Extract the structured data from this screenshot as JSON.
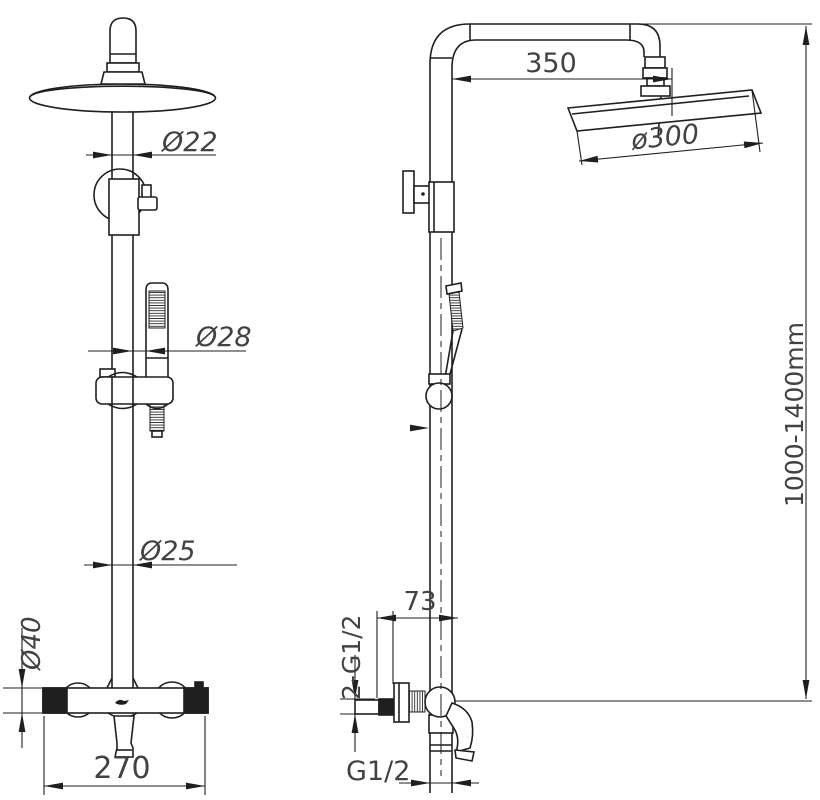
{
  "drawing": {
    "background": "#ffffff",
    "line_color": "#1f1f1f",
    "text_color": "#424242",
    "front_view": {
      "dim_pipe_top": "Ø22",
      "dim_hand_shower": "Ø28",
      "dim_pipe_lower": "Ø25",
      "dim_valve_body": "Ø40",
      "dim_valve_width": "270"
    },
    "side_view": {
      "dim_arm_reach": "350",
      "dim_head": "ø300",
      "dim_height_range": "1000-1400mm",
      "dim_wall_offset": "73",
      "dim_inlet_thread": "2-G1/2",
      "dim_outlet_thread": "G1/2"
    }
  }
}
